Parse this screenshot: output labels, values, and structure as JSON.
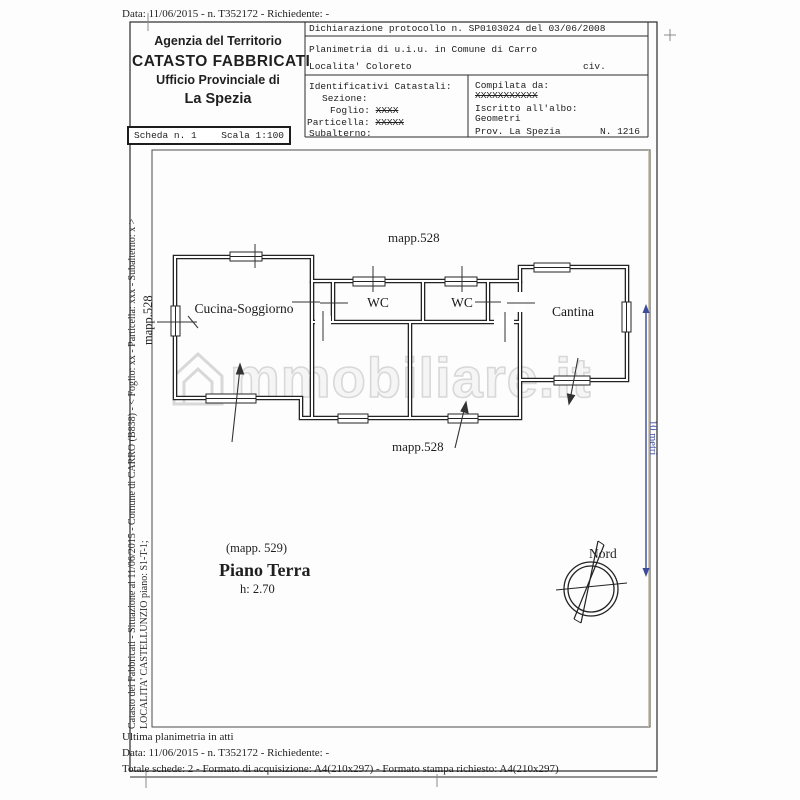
{
  "colors": {
    "accent_blue": "#3d4b9b",
    "line_dark": "#2b2b2b",
    "watermark_gray": "#d2d2d2"
  },
  "top": {
    "data_line": "Data: 11/06/2015 - n. T352172 - Richiedente: -"
  },
  "header": {
    "agency": {
      "line1": "Agenzia del Territorio",
      "line2": "CATASTO FABBRICATI",
      "line3": "Ufficio Provinciale di",
      "line4": "La Spezia"
    },
    "scheda": {
      "number": "Scheda n. 1",
      "scale": "Scala 1:100"
    },
    "declaration": "Dichiarazione protocollo n. SP0103024 del 03/06/2008",
    "planimetria": "Planimetria di u.i.u. in Comune di Carro",
    "localita": "Localita' Coloreto",
    "civ": "civ.",
    "identificativi": {
      "title": "Identificativi Catastali:",
      "sezione": "Sezione:",
      "foglio_label": "Foglio:",
      "foglio_value": "XXXX",
      "particella_label": "Particella:",
      "particella_value": "XXXXX",
      "subalterno": "Subalterno:"
    },
    "compilata": {
      "title": "Compilata da:",
      "name": "XXXXXXXXXXX",
      "albo_label": "Iscritto all'albo:",
      "albo_value": "Geometri",
      "prov": "Prov. La Spezia",
      "numero": "N. 1216"
    }
  },
  "plan": {
    "mapp_top": "mapp.528",
    "mapp_bottom": "mapp.528",
    "mapp_left": "mapp.528",
    "rooms": {
      "cucina": "Cucina-Soggiorno",
      "wc1": "WC",
      "wc2": "WC",
      "cantina": "Cantina"
    },
    "mapp_parcel": "(mapp. 529)",
    "floor_title": "Piano Terra",
    "floor_height": "h: 2.70",
    "north": "Nord",
    "dimension": "10 metri",
    "watermark": "mmobiliare.it"
  },
  "sidebar": {
    "line1": "Catasto dei Fabbricati - Situazione al 11/06/2015 - Comune di CARRO (B838) - < Foglio: xx - Particella: xxx - Subalterno: x >",
    "line2": "LOCALITA' CASTELLUNZIO piano: S1-T-1;"
  },
  "footer": {
    "line1": "Ultima planimetria in atti",
    "line2": "Data: 11/06/2015 - n. T352172 - Richiedente: -",
    "line3": "Totale schede: 2 - Formato di acquisizione: A4(210x297)  - Formato stampa richiesto: A4(210x297)"
  }
}
